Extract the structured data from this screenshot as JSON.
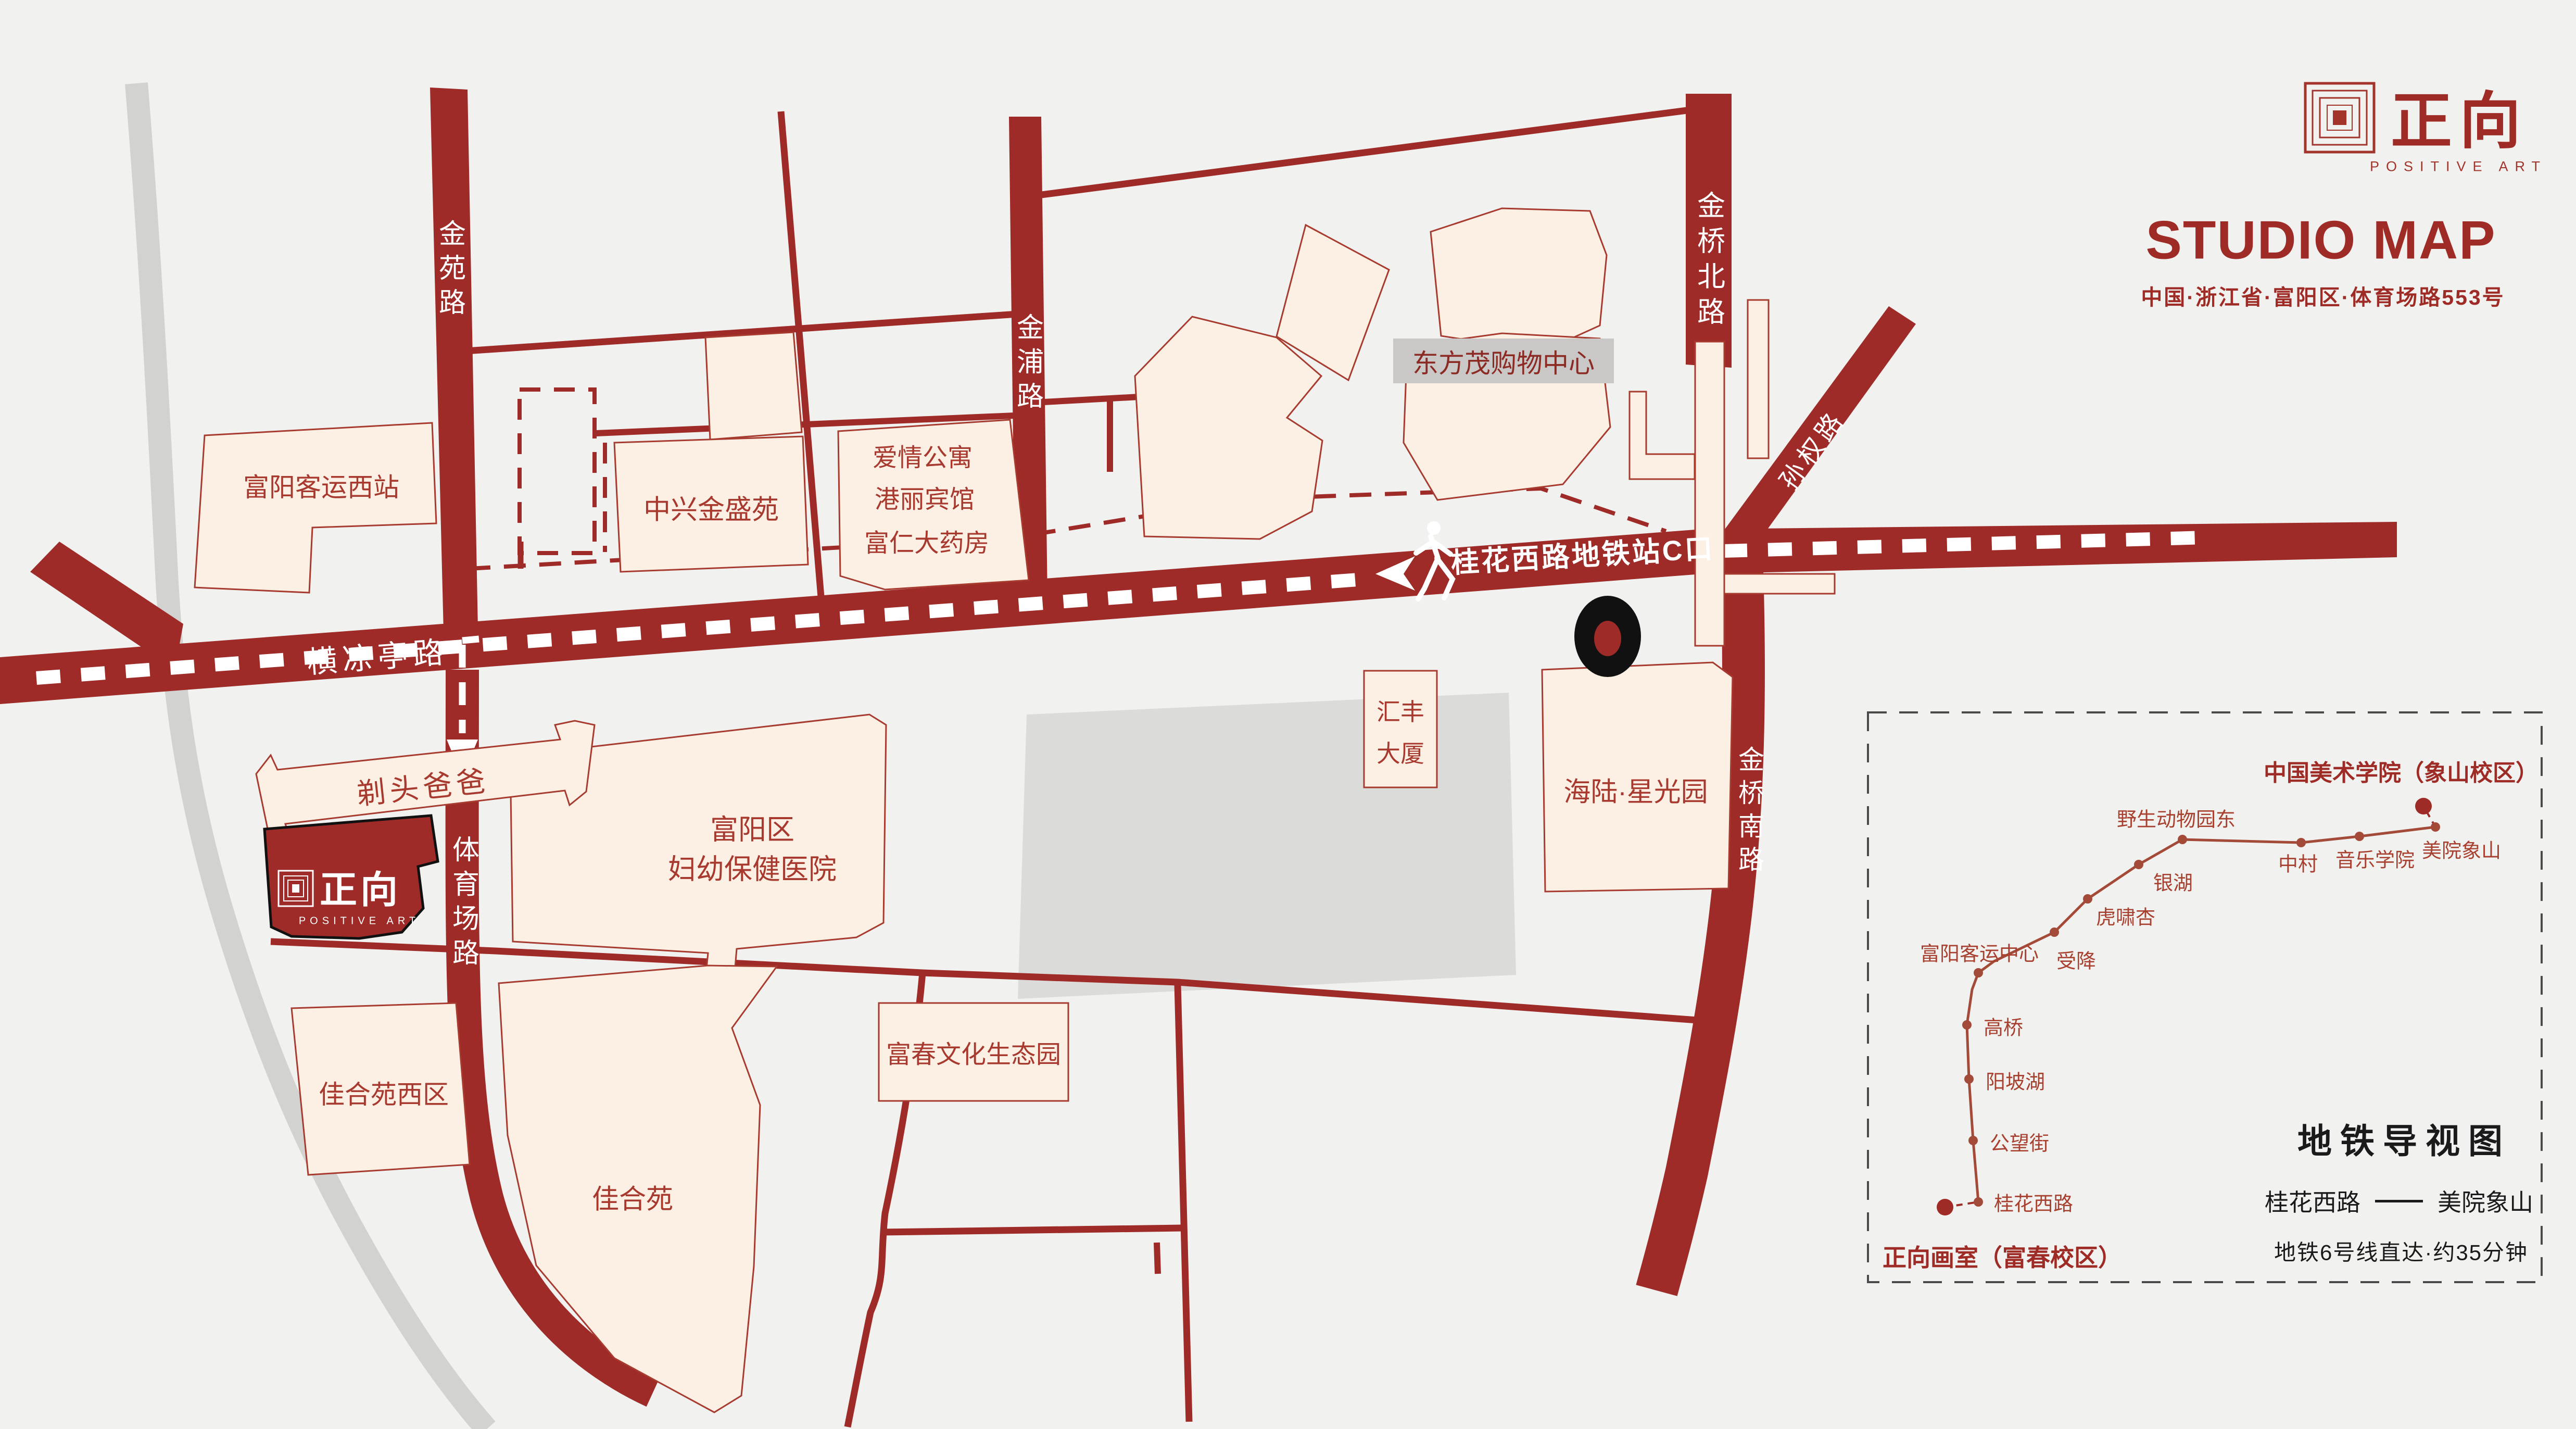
{
  "brand": {
    "name_zh": "正向",
    "name_en": "POSITIVE ART"
  },
  "header": {
    "title": "STUDIO MAP",
    "address": "中国·浙江省·富阳区·体育场路553号"
  },
  "map": {
    "roads": {
      "hengliangting": "横凉亭路",
      "jinyuan": "金苑路",
      "tiyuchang": "体育场路",
      "jinpu": "金浦路",
      "jinqiao_north": "金桥北路",
      "jinqiao_south": "金桥南路",
      "sunquan": "孙权路"
    },
    "walk_banner": "桂花西路地铁站C口",
    "buildings": {
      "fuyang_west_bus": "富阳客运西站",
      "zhongxing": "中兴金盛苑",
      "apartment": "爱情公寓",
      "hotel": "港丽宾馆",
      "pharmacy": "富仁大药房",
      "dongfangmao": "东方茂购物中心",
      "huifeng_l1": "汇丰",
      "huifeng_l2": "大厦",
      "hailu": "海陆·星光园",
      "fuyang_l1": "富阳区",
      "fuyang_l2": "妇幼保健医院",
      "titou": "剃头爸爸",
      "jiaheyuan_west": "佳合苑西区",
      "jiaheyuan": "佳合苑",
      "fuchun_park": "富春文化生态园"
    }
  },
  "subway": {
    "title": "地铁导视图",
    "origin": "正向画室（富春校区）",
    "destination": "中国美术学院（象山校区）",
    "stations": [
      "桂花西路",
      "公望街",
      "阳坡湖",
      "高桥",
      "富阳客运中心",
      "受降",
      "虎啸杏",
      "银湖",
      "野生动物园东",
      "中村",
      "音乐学院",
      "美院象山"
    ],
    "route_from": "桂花西路",
    "route_to": "美院象山",
    "duration": "地铁6号线直达·约35分钟"
  }
}
